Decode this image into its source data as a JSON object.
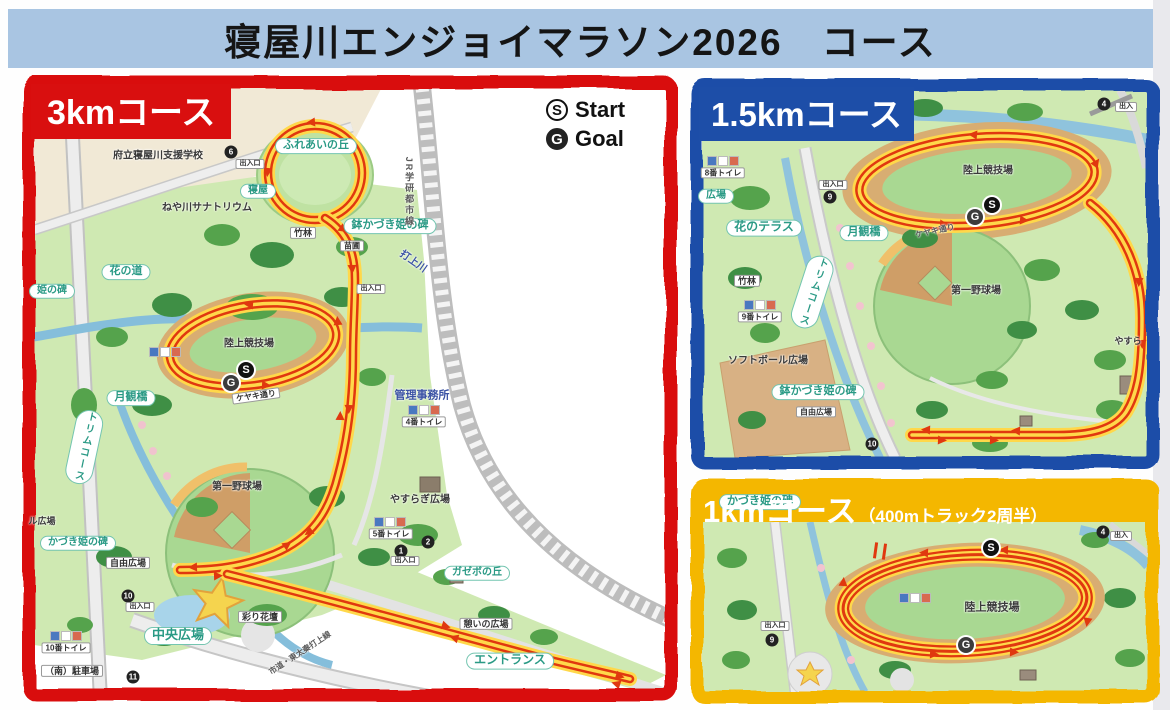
{
  "title": "寝屋川エンジョイマラソン2026　コース",
  "legend": {
    "start_symbol": "S",
    "start_label": "Start",
    "goal_symbol": "G",
    "goal_label": "Goal"
  },
  "colors": {
    "title_bar_bg": "#a9c5e2",
    "course_3km_border": "#d90f0f",
    "course_15km_border": "#1d4ea8",
    "course_1km_border": "#f4b700",
    "route_yellow": "#ffd84a",
    "route_red": "#e0380f"
  },
  "panels": [
    {
      "id": "course-3km",
      "title": "3kmコース",
      "labels": [
        {
          "kind": "plain",
          "text": "府立寝屋川支援学校",
          "x": 158,
          "y": 156,
          "size": 10
        },
        {
          "kind": "circled",
          "text": "6",
          "x": 231,
          "y": 152
        },
        {
          "kind": "box",
          "text": "出入口",
          "x": 250,
          "y": 164,
          "size": 7
        },
        {
          "kind": "pill",
          "text": "ふれあいの丘",
          "x": 316,
          "y": 146,
          "size": 11
        },
        {
          "kind": "pill",
          "text": "寝屋",
          "x": 258,
          "y": 191,
          "size": 10
        },
        {
          "kind": "plain",
          "text": "ねや川サナトリウム",
          "x": 207,
          "y": 208,
          "size": 10
        },
        {
          "kind": "box",
          "text": "竹林",
          "x": 303,
          "y": 233,
          "size": 9
        },
        {
          "kind": "box",
          "text": "苗圃",
          "x": 352,
          "y": 246,
          "size": 8
        },
        {
          "kind": "pill",
          "text": "鉢かづき姫の碑",
          "x": 390,
          "y": 226,
          "size": 11
        },
        {
          "kind": "blue",
          "text": "打上川",
          "x": 413,
          "y": 262,
          "size": 10,
          "rot": 35
        },
        {
          "kind": "dim",
          "text": "JR学研都市線",
          "x": 409,
          "y": 192,
          "size": 9,
          "vertical": true
        },
        {
          "kind": "pill",
          "text": "花の道",
          "x": 126,
          "y": 272,
          "size": 11
        },
        {
          "kind": "pill",
          "text": "姫の碑",
          "x": 52,
          "y": 291,
          "size": 10
        },
        {
          "kind": "box",
          "text": "出入口",
          "x": 371,
          "y": 289,
          "size": 7
        },
        {
          "kind": "plain",
          "text": "陸上競技場",
          "x": 249,
          "y": 344,
          "size": 10
        },
        {
          "kind": "icons",
          "x": 165,
          "y": 352
        },
        {
          "kind": "start",
          "text": "S",
          "x": 246,
          "y": 370
        },
        {
          "kind": "goal",
          "text": "G",
          "x": 231,
          "y": 383
        },
        {
          "kind": "box",
          "text": "ケヤキ通り",
          "x": 256,
          "y": 396,
          "size": 8,
          "rot": -8
        },
        {
          "kind": "pill",
          "text": "月観橋",
          "x": 131,
          "y": 398,
          "size": 11
        },
        {
          "kind": "pill",
          "text": "トリムコース",
          "x": 84,
          "y": 447,
          "size": 10,
          "vertical": true,
          "rot": 12
        },
        {
          "kind": "plain",
          "text": "第一野球場",
          "x": 237,
          "y": 487,
          "size": 10
        },
        {
          "kind": "blue",
          "text": "管理事務所",
          "x": 422,
          "y": 396,
          "size": 11
        },
        {
          "kind": "icons",
          "x": 424,
          "y": 410
        },
        {
          "kind": "box",
          "text": "4番トイレ",
          "x": 424,
          "y": 422,
          "size": 8
        },
        {
          "kind": "plain",
          "text": "やすらぎ広場",
          "x": 420,
          "y": 500,
          "size": 10
        },
        {
          "kind": "icons",
          "x": 390,
          "y": 522
        },
        {
          "kind": "box",
          "text": "5番トイレ",
          "x": 391,
          "y": 534,
          "size": 8
        },
        {
          "kind": "plain",
          "text": "ル広場",
          "x": 42,
          "y": 521,
          "size": 9
        },
        {
          "kind": "pill",
          "text": "かづき姫の碑",
          "x": 78,
          "y": 543,
          "size": 10
        },
        {
          "kind": "box",
          "text": "自由広場",
          "x": 128,
          "y": 563,
          "size": 9
        },
        {
          "kind": "circled",
          "text": "2",
          "x": 428,
          "y": 542
        },
        {
          "kind": "circled",
          "text": "1",
          "x": 401,
          "y": 551
        },
        {
          "kind": "box",
          "text": "出入口",
          "x": 405,
          "y": 561,
          "size": 7
        },
        {
          "kind": "pill",
          "text": "ガゼボの丘",
          "x": 477,
          "y": 573,
          "size": 10
        },
        {
          "kind": "box",
          "text": "彩り花壇",
          "x": 260,
          "y": 617,
          "size": 9
        },
        {
          "kind": "circled",
          "text": "10",
          "x": 128,
          "y": 596
        },
        {
          "kind": "box",
          "text": "出入口",
          "x": 140,
          "y": 607,
          "size": 7
        },
        {
          "kind": "pill",
          "text": "中央広場",
          "x": 178,
          "y": 636,
          "size": 13
        },
        {
          "kind": "dim",
          "text": "市道・東太秦打上線",
          "x": 300,
          "y": 653,
          "size": 8,
          "rot": -33
        },
        {
          "kind": "box",
          "text": "憩いの広場",
          "x": 486,
          "y": 624,
          "size": 9
        },
        {
          "kind": "pill",
          "text": "エントランス",
          "x": 510,
          "y": 661,
          "size": 12
        },
        {
          "kind": "icons",
          "x": 66,
          "y": 636
        },
        {
          "kind": "box",
          "text": "10番トイレ",
          "x": 66,
          "y": 648,
          "size": 8
        },
        {
          "kind": "box",
          "text": "（南）駐車場",
          "x": 72,
          "y": 671,
          "size": 9
        },
        {
          "kind": "circled",
          "text": "11",
          "x": 133,
          "y": 677
        }
      ]
    },
    {
      "id": "course-1-5km",
      "title": "1.5kmコース",
      "labels": [
        {
          "kind": "icons",
          "x": 723,
          "y": 161
        },
        {
          "kind": "box",
          "text": "8番トイレ",
          "x": 723,
          "y": 173,
          "size": 8
        },
        {
          "kind": "pill",
          "text": "広場",
          "x": 716,
          "y": 196,
          "size": 10
        },
        {
          "kind": "box",
          "text": "出入口",
          "x": 833,
          "y": 185,
          "size": 7
        },
        {
          "kind": "circled",
          "text": "9",
          "x": 830,
          "y": 197
        },
        {
          "kind": "pill",
          "text": "花のテラス",
          "x": 764,
          "y": 228,
          "size": 12
        },
        {
          "kind": "pill",
          "text": "月観橋",
          "x": 864,
          "y": 233,
          "size": 11
        },
        {
          "kind": "pill",
          "text": "トリムコース",
          "x": 812,
          "y": 292,
          "size": 10,
          "vertical": true,
          "rot": 18
        },
        {
          "kind": "box",
          "text": "竹林",
          "x": 747,
          "y": 281,
          "size": 9
        },
        {
          "kind": "icons",
          "x": 760,
          "y": 305
        },
        {
          "kind": "box",
          "text": "9番トイレ",
          "x": 760,
          "y": 317,
          "size": 8
        },
        {
          "kind": "plain",
          "text": "ソフトボール広場",
          "x": 768,
          "y": 361,
          "size": 10
        },
        {
          "kind": "pill",
          "text": "鉢かづき姫の碑",
          "x": 818,
          "y": 392,
          "size": 11
        },
        {
          "kind": "box",
          "text": "自由広場",
          "x": 816,
          "y": 412,
          "size": 8
        },
        {
          "kind": "plain",
          "text": "第一野球場",
          "x": 976,
          "y": 291,
          "size": 10
        },
        {
          "kind": "plain",
          "text": "陸上競技場",
          "x": 988,
          "y": 171,
          "size": 10
        },
        {
          "kind": "start",
          "text": "S",
          "x": 992,
          "y": 205
        },
        {
          "kind": "goal",
          "text": "G",
          "x": 975,
          "y": 217
        },
        {
          "kind": "dim",
          "text": "ケヤキ通り",
          "x": 935,
          "y": 231,
          "size": 8,
          "rot": -12
        },
        {
          "kind": "circled",
          "text": "4",
          "x": 1104,
          "y": 104
        },
        {
          "kind": "box",
          "text": "出入",
          "x": 1126,
          "y": 107,
          "size": 7
        },
        {
          "kind": "plain",
          "text": "やすら",
          "x": 1128,
          "y": 341,
          "size": 9
        },
        {
          "kind": "circled",
          "text": "10",
          "x": 872,
          "y": 444
        }
      ]
    },
    {
      "id": "course-1km",
      "title": "1kmコース",
      "title_suffix": "（400mトラック2周半）",
      "labels": [
        {
          "kind": "pill",
          "text": "かづき姫の碑",
          "x": 760,
          "y": 502,
          "size": 11
        },
        {
          "kind": "circled",
          "text": "4",
          "x": 1103,
          "y": 532
        },
        {
          "kind": "box",
          "text": "出入",
          "x": 1121,
          "y": 536,
          "size": 7
        },
        {
          "kind": "start",
          "text": "S",
          "x": 991,
          "y": 548
        },
        {
          "kind": "plain",
          "text": "陸上競技場",
          "x": 992,
          "y": 608,
          "size": 11
        },
        {
          "kind": "icons",
          "x": 915,
          "y": 598
        },
        {
          "kind": "goal",
          "text": "G",
          "x": 966,
          "y": 645
        },
        {
          "kind": "box",
          "text": "出入口",
          "x": 775,
          "y": 626,
          "size": 7
        },
        {
          "kind": "circled",
          "text": "9",
          "x": 772,
          "y": 640
        }
      ]
    }
  ]
}
